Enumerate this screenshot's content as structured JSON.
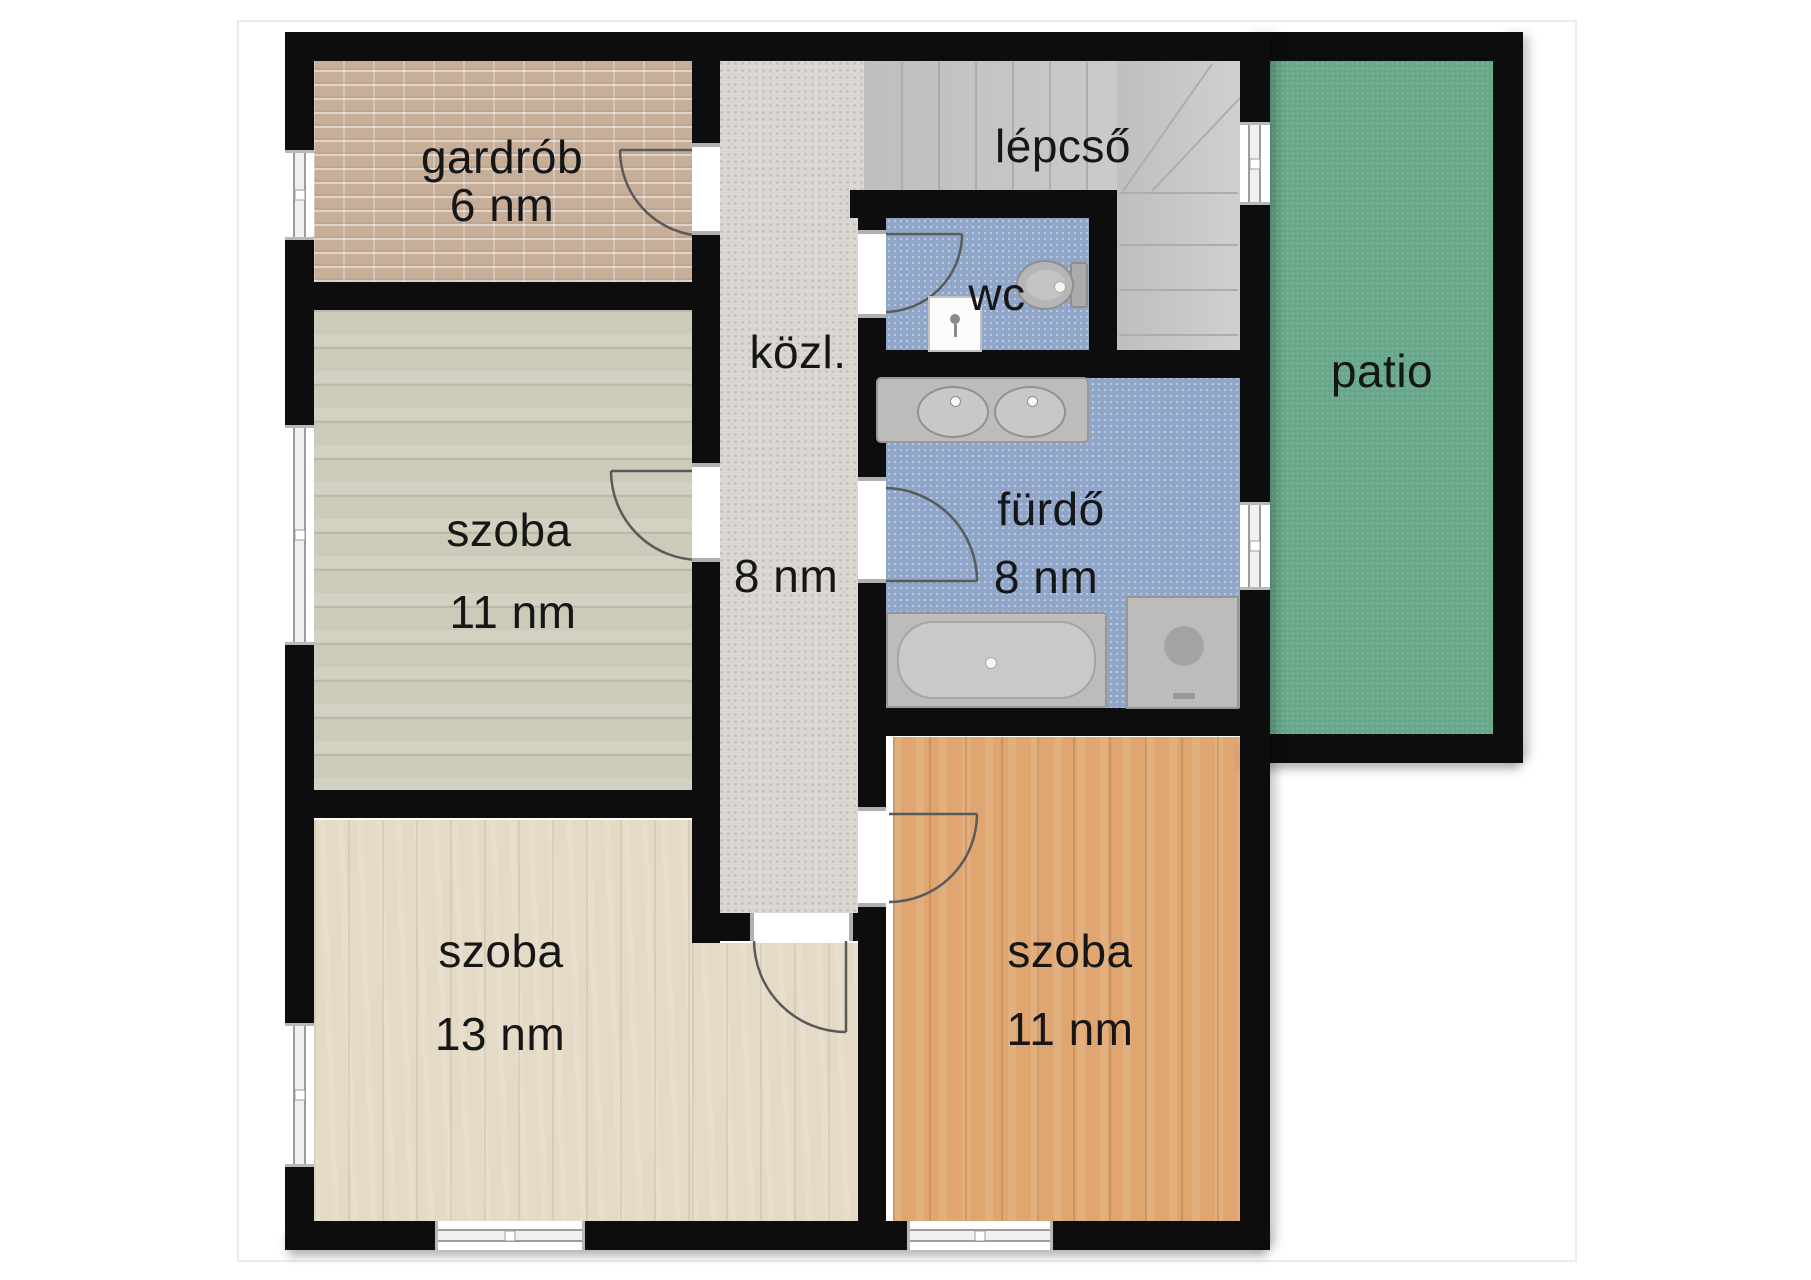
{
  "rooms": {
    "gardrob": {
      "name": "gardrób",
      "area": "6 nm"
    },
    "lepcso": {
      "name": "lépcső"
    },
    "wc": {
      "name": "wc"
    },
    "kozl": {
      "name": "közl.",
      "area": "8 nm"
    },
    "furdo": {
      "name": "fürdő",
      "area": "8 nm"
    },
    "patio": {
      "name": "patio"
    },
    "szoba_left": {
      "name": "szoba",
      "area": "11 nm"
    },
    "szoba_bottom_left": {
      "name": "szoba",
      "area": "13 nm"
    },
    "szoba_bottom_right": {
      "name": "szoba",
      "area": "11 nm"
    }
  },
  "colors": {
    "wall": "#0d0d0d",
    "gardrob-floor": "#c6ae99",
    "corridor-floor": "#dad7d2",
    "stairs-floor": "#c9c9c9",
    "wet-floor": "#8fa6c9",
    "patio-floor": "#67a78a",
    "szoba-left-floor": "#cccbba",
    "szoba-13-floor": "#e4dac6",
    "szoba-11-floor": "#dfa671",
    "fixture": "#bcbcbc",
    "label-text": "#161616"
  }
}
